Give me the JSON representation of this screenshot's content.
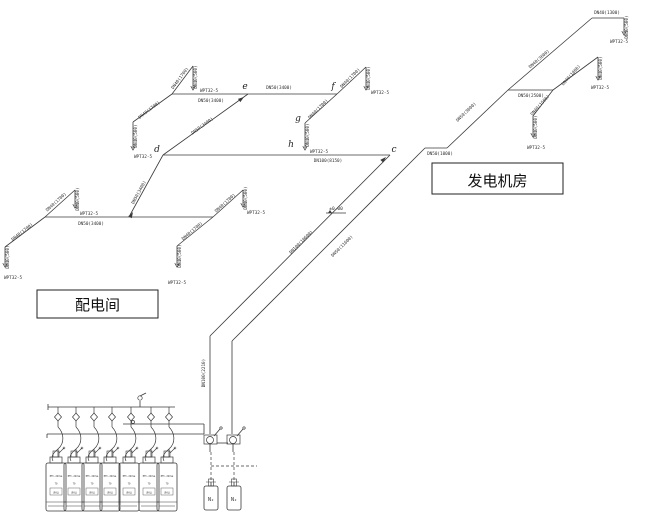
{
  "drawing": {
    "title_rooms": [
      {
        "label": "配电间",
        "x": 37,
        "y": 290,
        "w": 121,
        "h": 28
      },
      {
        "label": "发电机房",
        "x": 432,
        "y": 163,
        "w": 131,
        "h": 31
      }
    ],
    "nozzle_label": "WPT32-5",
    "elevation_label": "±0.00",
    "line_color": "#3a3a3a",
    "nodes": [
      {
        "t": "c",
        "x": 394,
        "y": 152
      },
      {
        "t": "d",
        "x": 157,
        "y": 152
      },
      {
        "t": "e",
        "x": 245,
        "y": 89
      },
      {
        "t": "f",
        "x": 333,
        "y": 89
      },
      {
        "t": "g",
        "x": 298,
        "y": 121
      },
      {
        "t": "h",
        "x": 291,
        "y": 147
      }
    ],
    "pipe_labels": [
      {
        "t": "DN40(1700)",
        "x": 150,
        "y": 111,
        "r": -38
      },
      {
        "t": "DN40(500)",
        "x": 137,
        "y": 136,
        "r": -90
      },
      {
        "t": "DN40(1700)",
        "x": 181,
        "y": 79,
        "r": -53
      },
      {
        "t": "DN40(500)",
        "x": 197,
        "y": 77,
        "r": -90
      },
      {
        "t": "DN50(3400)",
        "x": 211,
        "y": 102,
        "r": 0
      },
      {
        "t": "DN50(3400)",
        "x": 279,
        "y": 89,
        "r": 0
      },
      {
        "t": "DN40(1700)",
        "x": 351,
        "y": 79,
        "r": -45
      },
      {
        "t": "DN40(500)",
        "x": 370,
        "y": 78,
        "r": -90
      },
      {
        "t": "DN40(1700)",
        "x": 319,
        "y": 110,
        "r": -45
      },
      {
        "t": "DN40(500)",
        "x": 309,
        "y": 135,
        "r": -90
      },
      {
        "t": "DN50(3400)",
        "x": 203,
        "y": 127,
        "r": -36
      },
      {
        "t": "DN100(8150)",
        "x": 328,
        "y": 162,
        "r": 0
      },
      {
        "t": "DN50(3400)",
        "x": 140,
        "y": 193,
        "r": -61
      },
      {
        "t": "DN50(3400)",
        "x": 91,
        "y": 225,
        "r": 0
      },
      {
        "t": "DN40(1700)",
        "x": 57,
        "y": 203,
        "r": -42
      },
      {
        "t": "DN40(500)",
        "x": 79,
        "y": 199,
        "r": -90
      },
      {
        "t": "DN40(1700)",
        "x": 23,
        "y": 233,
        "r": -38
      },
      {
        "t": "DN40(500)",
        "x": 9,
        "y": 257,
        "r": -90
      },
      {
        "t": "DN40(1700)",
        "x": 226,
        "y": 204,
        "r": -42
      },
      {
        "t": "DN40(500)",
        "x": 247,
        "y": 198,
        "r": -90
      },
      {
        "t": "DN40(1700)",
        "x": 193,
        "y": 232,
        "r": -40
      },
      {
        "t": "DN40(500)",
        "x": 181,
        "y": 256,
        "r": -90
      },
      {
        "t": "DN100(10600)",
        "x": 302,
        "y": 243,
        "r": -45
      },
      {
        "t": "DN50(11600)",
        "x": 343,
        "y": 247,
        "r": -45
      },
      {
        "t": "DN100(2210)",
        "x": 205,
        "y": 373,
        "r": -90
      },
      {
        "t": "DN50(1000)",
        "x": 440,
        "y": 155,
        "r": 0
      },
      {
        "t": "DN50(3000)",
        "x": 467,
        "y": 113,
        "r": -44
      },
      {
        "t": "DN40(3600)",
        "x": 540,
        "y": 60,
        "r": -41
      },
      {
        "t": "DN40(1300)",
        "x": 607,
        "y": 14,
        "r": 0
      },
      {
        "t": "DN40(500)",
        "x": 628,
        "y": 27,
        "r": -90
      },
      {
        "t": "DN50(2500)",
        "x": 531,
        "y": 97,
        "r": 0
      },
      {
        "t": "DN40(1800)",
        "x": 572,
        "y": 76,
        "r": -48
      },
      {
        "t": "DN40(500)",
        "x": 602,
        "y": 68,
        "r": -90
      },
      {
        "t": "DN40(1500)",
        "x": 541,
        "y": 106,
        "r": -48
      },
      {
        "t": "DN40(500)",
        "x": 537,
        "y": 127,
        "r": -90
      }
    ],
    "nozzles": [
      {
        "x": 133,
        "y": 150,
        "lx": 143,
        "ly": 158
      },
      {
        "x": 193,
        "y": 90,
        "lx": 209,
        "ly": 92
      },
      {
        "x": 366,
        "y": 90,
        "lx": 380,
        "ly": 94
      },
      {
        "x": 305,
        "y": 150,
        "lx": 319,
        "ly": 153
      },
      {
        "x": 75,
        "y": 208,
        "lx": 89,
        "ly": 215
      },
      {
        "x": 5,
        "y": 267,
        "lx": 13,
        "ly": 279
      },
      {
        "x": 243,
        "y": 207,
        "lx": 256,
        "ly": 214
      },
      {
        "x": 177,
        "y": 267,
        "lx": 177,
        "ly": 284
      },
      {
        "x": 624,
        "y": 35,
        "lx": 619,
        "ly": 43
      },
      {
        "x": 598,
        "y": 80,
        "lx": 600,
        "ly": 89
      },
      {
        "x": 533,
        "y": 137,
        "lx": 536,
        "ly": 149
      }
    ],
    "lines": [
      [
        172,
        94,
        337,
        94
      ],
      [
        172,
        94,
        133,
        122
      ],
      [
        133,
        122,
        133,
        148
      ],
      [
        172,
        94,
        193,
        66
      ],
      [
        193,
        66,
        193,
        88
      ],
      [
        337,
        94,
        366,
        67
      ],
      [
        366,
        67,
        366,
        88
      ],
      [
        337,
        94,
        305,
        123
      ],
      [
        305,
        123,
        305,
        148
      ],
      [
        163,
        155,
        248,
        94
      ],
      [
        163,
        155,
        390,
        155
      ],
      [
        130,
        215,
        163,
        155
      ],
      [
        45,
        217,
        213,
        217
      ],
      [
        45,
        217,
        75,
        190
      ],
      [
        75,
        190,
        75,
        206
      ],
      [
        45,
        217,
        5,
        247
      ],
      [
        5,
        247,
        5,
        265
      ],
      [
        213,
        217,
        243,
        190
      ],
      [
        243,
        190,
        243,
        205
      ],
      [
        213,
        217,
        177,
        246
      ],
      [
        177,
        246,
        177,
        265
      ],
      [
        390,
        155,
        210,
        336
      ],
      [
        210,
        336,
        210,
        434
      ],
      [
        425,
        148,
        232,
        341
      ],
      [
        232,
        341,
        232,
        434
      ],
      [
        425,
        148,
        447,
        148
      ],
      [
        447,
        148,
        508,
        90
      ],
      [
        508,
        90,
        592,
        18
      ],
      [
        592,
        18,
        624,
        18
      ],
      [
        624,
        18,
        624,
        33
      ],
      [
        508,
        90,
        553,
        90
      ],
      [
        553,
        90,
        598,
        57
      ],
      [
        598,
        57,
        598,
        78
      ],
      [
        553,
        90,
        533,
        116
      ],
      [
        533,
        116,
        533,
        135
      ],
      [
        326,
        213,
        346,
        213
      ],
      [
        48,
        407,
        175,
        407
      ],
      [
        48,
        404,
        48,
        410
      ],
      [
        140,
        407,
        140,
        401
      ],
      [
        140,
        396,
        146,
        393
      ],
      [
        47,
        434,
        204,
        434
      ],
      [
        123,
        424,
        204,
        424
      ],
      [
        204,
        424,
        204,
        434
      ],
      [
        47,
        434,
        47,
        438
      ],
      [
        217,
        443,
        228,
        443
      ],
      [
        210,
        444,
        210,
        452
      ],
      [
        233,
        444,
        233,
        452
      ],
      [
        214,
        436,
        220,
        429
      ],
      [
        237,
        436,
        243,
        429
      ],
      [
        211,
        482,
        211,
        486
      ],
      [
        234,
        482,
        234,
        486
      ]
    ],
    "dashed_lines": [
      [
        211,
        452,
        211,
        482
      ],
      [
        234,
        452,
        234,
        482
      ],
      [
        211,
        466,
        257,
        466
      ]
    ],
    "rects": [
      [
        204,
        435,
        13,
        9
      ],
      [
        227,
        435,
        13,
        9
      ]
    ],
    "circles": [
      [
        140,
        398,
        2.2
      ],
      [
        133,
        422,
        1.5
      ],
      [
        210,
        440,
        3.5
      ],
      [
        233,
        440,
        3.5
      ],
      [
        221,
        428,
        1.2
      ],
      [
        244,
        428,
        1.2
      ]
    ],
    "flow_arrows": [
      {
        "x": 386,
        "y": 157,
        "r": -45
      },
      {
        "x": 133,
        "y": 212,
        "r": -60
      },
      {
        "x": 244,
        "y": 97,
        "r": -36
      }
    ],
    "check_valves": [
      {
        "x": 58,
        "y": 417
      },
      {
        "x": 76,
        "y": 417
      },
      {
        "x": 94,
        "y": 417
      },
      {
        "x": 112,
        "y": 417
      },
      {
        "x": 131,
        "y": 417
      },
      {
        "x": 151,
        "y": 417
      },
      {
        "x": 169,
        "y": 417
      }
    ],
    "elevation_marker": {
      "x": 336,
      "y": 210
    },
    "cylinders": {
      "centers": [
        56,
        74,
        92,
        110,
        129,
        149,
        167
      ],
      "text_lines": [
        "HFC-227ea",
        "70",
        "(90L)"
      ]
    },
    "pilot_cylinders": {
      "centers": [
        211,
        234
      ],
      "label": "N₂"
    }
  }
}
